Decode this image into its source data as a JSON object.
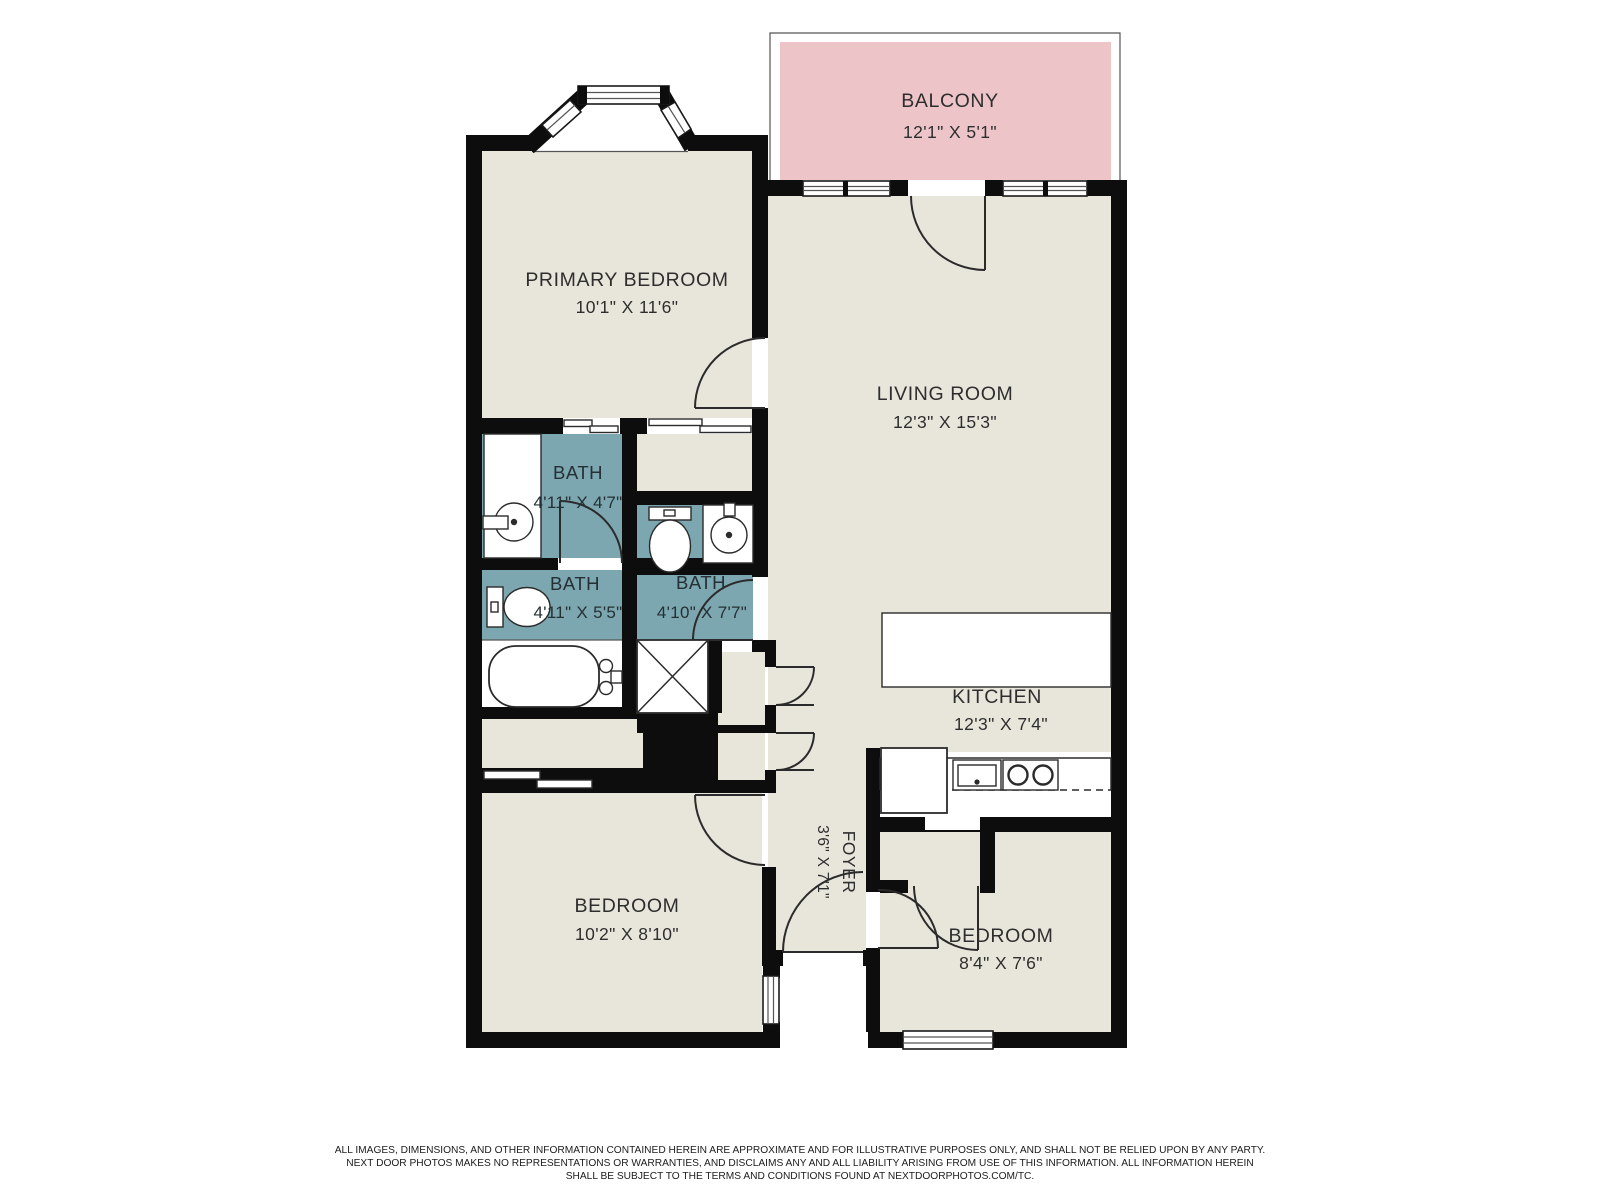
{
  "plan": {
    "rooms": [
      {
        "id": "balcony",
        "name": "BALCONY",
        "dims": "12'1\" X 5'1\""
      },
      {
        "id": "primary-bedroom",
        "name": "PRIMARY BEDROOM",
        "dims": "10'1\" X 11'6\""
      },
      {
        "id": "living-room",
        "name": "LIVING ROOM",
        "dims": "12'3\" X 15'3\""
      },
      {
        "id": "bath-1",
        "name": "BATH",
        "dims": "4'11\" X 4'7\""
      },
      {
        "id": "bath-2",
        "name": "BATH",
        "dims": "4'11\" X 5'5\""
      },
      {
        "id": "bath-3",
        "name": "BATH",
        "dims": "4'10\" X 7'7\""
      },
      {
        "id": "kitchen",
        "name": "KITCHEN",
        "dims": "12'3\" X 7'4\""
      },
      {
        "id": "foyer",
        "name": "FOYER",
        "dims": "3'6\" X 7'1\""
      },
      {
        "id": "bedroom-1",
        "name": "BEDROOM",
        "dims": "10'2\" X 8'10\""
      },
      {
        "id": "bedroom-2",
        "name": "BEDROOM",
        "dims": "8'4\" X 7'6\""
      }
    ],
    "colors": {
      "wall": "#0d0d0d",
      "floor": "#e8e6db",
      "bath": "#7ca6b0",
      "balcony": "#edc4c8",
      "line": "#2b2b2b",
      "background": "#ffffff"
    },
    "disclaimer": {
      "line1": "ALL IMAGES, DIMENSIONS, AND OTHER INFORMATION CONTAINED HEREIN ARE APPROXIMATE AND FOR ILLUSTRATIVE PURPOSES ONLY, AND SHALL NOT BE RELIED UPON BY ANY PARTY.",
      "line2": "NEXT DOOR PHOTOS MAKES NO REPRESENTATIONS OR WARRANTIES, AND DISCLAIMS ANY AND ALL LIABILITY ARISING FROM USE OF THIS INFORMATION. ALL INFORMATION HEREIN",
      "line3": "SHALL BE SUBJECT TO THE TERMS AND CONDITIONS FOUND AT NEXTDOORPHOTOS.COM/TC."
    }
  }
}
